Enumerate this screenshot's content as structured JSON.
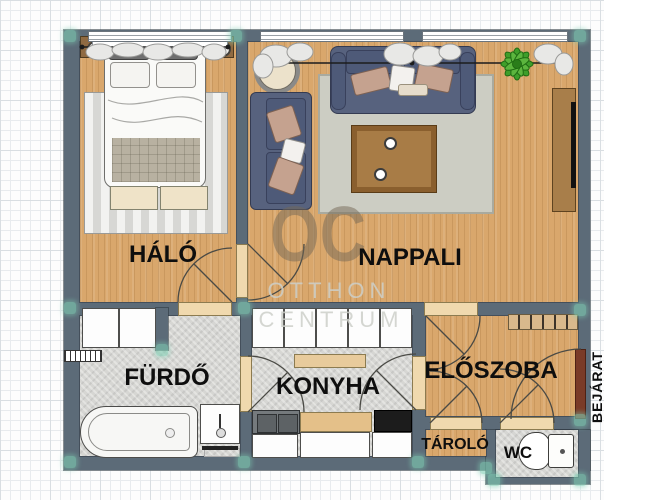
{
  "floorplan": {
    "watermark": {
      "monogram": "OC",
      "line1": "OTTHON",
      "line2": "CENTRUM"
    },
    "rooms": {
      "bedroom": {
        "label": "HÁLÓ",
        "floor": "wood"
      },
      "living_room": {
        "label": "NAPPALI",
        "floor": "wood"
      },
      "bathroom": {
        "label": "FÜRDŐ",
        "floor": "tile"
      },
      "kitchen": {
        "label": "KONYHA",
        "floor": "tile"
      },
      "hallway": {
        "label": "ELŐSZOBA",
        "floor": "wood"
      },
      "storage": {
        "label": "TÁROLÓ",
        "floor": "wood"
      },
      "toilet": {
        "label": "WC",
        "floor": "tile"
      }
    },
    "entrance": {
      "label": "BEJÁRAT"
    },
    "colors": {
      "wall": "#5c6b78",
      "wood_floor": "#d9a76c",
      "tile_floor": "#d6d6d3",
      "sofa": "#57627e",
      "entrance_door": "#7a3b28",
      "door_threshold": "#f0d9ae",
      "corner_marker": "#7ecfb4",
      "plant": "#3f9e2a"
    }
  }
}
